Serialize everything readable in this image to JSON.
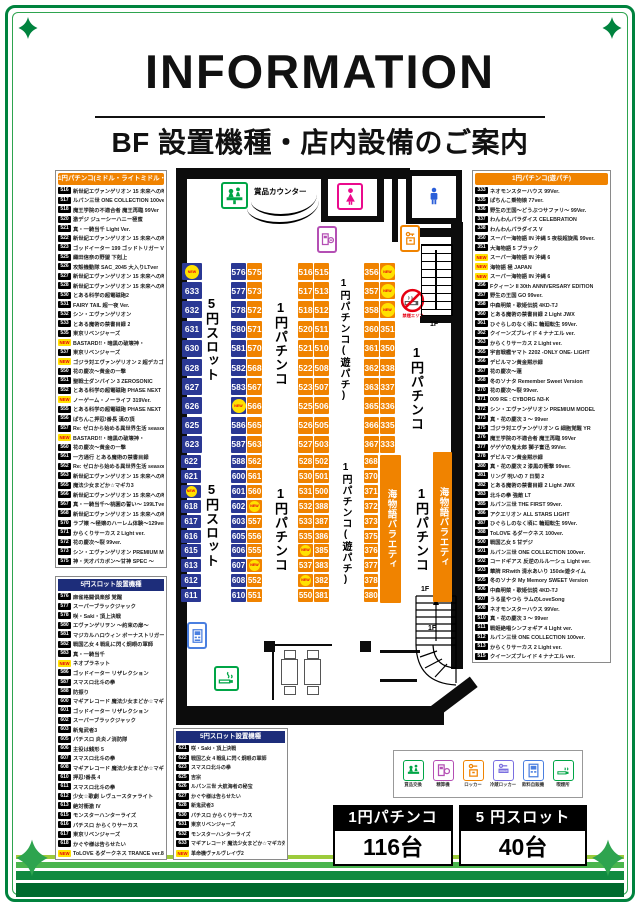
{
  "header": {
    "title": "INFORMATION",
    "subtitle": "BF 設置機種・店内設備のご案内"
  },
  "colors": {
    "accent_orange": "#f08300",
    "seat_blue": "#2a3894",
    "navy_header": "#1d2d7a",
    "new_yellow": "#ffe100",
    "new_red": "#e60012",
    "frame_green": "#00833e"
  },
  "lists": {
    "pachinko_middle": {
      "title": "1円パチンコ(ミドル・ライトミドル・ライト)",
      "items": [
        {
          "no": "516",
          "name": "新世紀エヴァンゲリオン 15 未来への咆哮 Y"
        },
        {
          "no": "517",
          "name": "ルパン三世 ONE COLLECTION 100ver."
        },
        {
          "no": "518",
          "name": "魔王学院の不適合者 魔王再臨 99Ver"
        },
        {
          "no": "520",
          "name": "激デジ ジューシーハニー極蜜"
        },
        {
          "no": "521",
          "name": "真・一騎当千 Light Ver."
        },
        {
          "no": "522",
          "name": "新世紀エヴァンゲリオン 15 未来への咆哮 F"
        },
        {
          "no": "523",
          "name": "ゴッドイーター 199 ゴッドトリガー VER."
        },
        {
          "no": "525",
          "name": "織田信奈の野望 下剋上"
        },
        {
          "no": "526",
          "name": "攻殻機動隊 SAC_2045 大入りLTver"
        },
        {
          "no": "527",
          "name": "新世紀エヴァンゲリオン 15 未来への咆哮 F"
        },
        {
          "no": "528",
          "name": "新世紀エヴァンゲリオン 15 未来への咆哮 F"
        },
        {
          "no": "530",
          "name": "とある科学の超電磁砲2"
        },
        {
          "no": "531",
          "name": "FAIRY TAIL 超一夜 Ver."
        },
        {
          "no": "532",
          "name": "シン・エヴァンゲリオン"
        },
        {
          "no": "533",
          "name": "とある魔術の禁書目録 2"
        },
        {
          "no": "535",
          "name": "東京リベンジャーズ"
        },
        {
          "no": "NEW",
          "name": "BASTARD!!・暗黒の破壊神・"
        },
        {
          "no": "537",
          "name": "東京リベンジャーズ"
        },
        {
          "no": "NEW",
          "name": "ゴジラ対エヴァンゲリオン 2 超デカゴールド"
        },
        {
          "no": "550",
          "name": "花の慶次〜黄金の一撃"
        },
        {
          "no": "551",
          "name": "聖戦士ダンバイン 3 ZEROSONIC"
        },
        {
          "no": "552",
          "name": "とある科学の超電磁砲 PHASE NEXT"
        },
        {
          "no": "NEW",
          "name": "ノーゲーム・ノーライフ 319Ver."
        },
        {
          "no": "555",
          "name": "とある科学の超電磁砲 PHASE NEXT"
        },
        {
          "no": "556",
          "name": "ぱちんこ押忍!番長 漢の頂"
        },
        {
          "no": "557",
          "name": "Re: ゼロから始める異世界生活 season2"
        },
        {
          "no": "NEW",
          "name": "BASTARD!!・暗黒の破壊神・"
        },
        {
          "no": "560",
          "name": "花の慶次〜黄金の一撃"
        },
        {
          "no": "561",
          "name": "一方通行 とある魔術の禁書目録"
        },
        {
          "no": "562",
          "name": "Re: ゼロから始める異世界生活 season2"
        },
        {
          "no": "563",
          "name": "新世紀エヴァンゲリオン 15 未来への咆哮 F"
        },
        {
          "no": "565",
          "name": "魔法少女まどか☆マギカ3"
        },
        {
          "no": "566",
          "name": "新世紀エヴァンゲリオン 15 未来への咆哮 F"
        },
        {
          "no": "567",
          "name": "真・一騎当千〜桃園の誓い〜 199LTver."
        },
        {
          "no": "568",
          "name": "新世紀エヴァンゲリオン 15 未来への咆哮 F"
        },
        {
          "no": "570",
          "name": "ラブ嬢 〜極嬢のハーレム体験〜129ver."
        },
        {
          "no": "571",
          "name": "からくりサーカス 2 Light ver."
        },
        {
          "no": "572",
          "name": "花の慶次〜裂 99ver."
        },
        {
          "no": "573",
          "name": "シン・エヴァンゲリオン PREMIUM MODEL"
        },
        {
          "no": "575",
          "name": "神・天才バカボン〜甘神 SPEC 〜"
        }
      ]
    },
    "slot_left": {
      "title": "5円スロット設置機種",
      "items": [
        {
          "no": "576",
          "name": "麻雀格闘倶楽部 覚醒"
        },
        {
          "no": "577",
          "name": "スーパーブラックジャック"
        },
        {
          "no": "578",
          "name": "咲・Saki・頂上決戦"
        },
        {
          "no": "580",
          "name": "エヴァンゲリヲン 〜約束の扉〜"
        },
        {
          "no": "581",
          "name": "マジカルハロウィン ボーナストリガー"
        },
        {
          "no": "582",
          "name": "戦国乙女 4 戦乱に閃く炯眼の軍師"
        },
        {
          "no": "583",
          "name": "真・一騎当千"
        },
        {
          "no": "NEW",
          "name": "ネオプラネット"
        },
        {
          "no": "586",
          "name": "ゴッドイーター リザレクション"
        },
        {
          "no": "587",
          "name": "スマスロ北斗の拳"
        },
        {
          "no": "588",
          "name": "防振り"
        },
        {
          "no": "600",
          "name": "マギアレコード 魔法少女まどか☆マギカ外伝"
        },
        {
          "no": "601",
          "name": "ゴッドイーター リザレクション"
        },
        {
          "no": "602",
          "name": "スーパーブラックジャック"
        },
        {
          "no": "603",
          "name": "新鬼武者3"
        },
        {
          "no": "605",
          "name": "パチスロ 炎炎ノ消防隊"
        },
        {
          "no": "606",
          "name": "主役は銭形 5"
        },
        {
          "no": "607",
          "name": "スマスロ北斗の拳"
        },
        {
          "no": "608",
          "name": "マギアレコード 魔法少女まどか☆マギカ外伝"
        },
        {
          "no": "610",
          "name": "押忍!番長 4"
        },
        {
          "no": "611",
          "name": "スマスロ北斗の拳"
        },
        {
          "no": "612",
          "name": "少女☆歌劇 レヴュースタァライト"
        },
        {
          "no": "613",
          "name": "絶対衝激 IV"
        },
        {
          "no": "615",
          "name": "モンスターハンターライズ"
        },
        {
          "no": "616",
          "name": "パチスロ からくりサーカス"
        },
        {
          "no": "617",
          "name": "東京リベンジャーズ"
        },
        {
          "no": "618",
          "name": "かぐや様は告らせたい"
        },
        {
          "no": "NEW",
          "name": "ToLOVE るダークネス TRANCE ver.8.7"
        }
      ]
    },
    "pachinko_yupachi": {
      "title": "1円パチンコ(遊パチ)",
      "items": [
        {
          "no": "333",
          "name": "ネオモンスターハウス 99Ver."
        },
        {
          "no": "335",
          "name": "ぱちんこ乗物娘 77ver."
        },
        {
          "no": "336",
          "name": "野生の王国〜どうぶつサファリ〜 99Ver."
        },
        {
          "no": "337",
          "name": "わんわんパラダイス CELEBRATION"
        },
        {
          "no": "338",
          "name": "わんわんパラダイス V"
        },
        {
          "no": "350",
          "name": "スーパー海物語 IN 沖縄 5 夜桜超旋風 99ver."
        },
        {
          "no": "351",
          "name": "大海物語 5 ブラック"
        },
        {
          "no": "NEW",
          "name": "スーパー海物語 IN 沖縄 6"
        },
        {
          "no": "NEW",
          "name": "海物語 極 JAPAN"
        },
        {
          "no": "NEW",
          "name": "スーパー海物語 IN 沖縄 6"
        },
        {
          "no": "356",
          "name": "Fクィーン II 30th ANNIVERSARY EDITION"
        },
        {
          "no": "357",
          "name": "野生の王国 GO 99ver."
        },
        {
          "no": "358",
          "name": "中森明菜・歌姫伝説 4KD-TJ"
        },
        {
          "no": "360",
          "name": "とある魔術の禁書目録 2 Light JWX"
        },
        {
          "no": "361",
          "name": "ひぐらしのなく頃に 輪廻転生 99Ver."
        },
        {
          "no": "362",
          "name": "クイーンズブレイド 4 ナナエル ver."
        },
        {
          "no": "363",
          "name": "からくりサーカス 2 Light ver."
        },
        {
          "no": "365",
          "name": "宇宙戦艦ヤマト 2202 -ONLY ONE- LIGHT"
        },
        {
          "no": "366",
          "name": "デビルマン黄金黙示録"
        },
        {
          "no": "367",
          "name": "花の慶次〜蓮"
        },
        {
          "no": "368",
          "name": "冬のソナタ Remember Sweet Version"
        },
        {
          "no": "370",
          "name": "花の慶次〜裂 99ver."
        },
        {
          "no": "371",
          "name": "009 RE : CYBORG N3-K"
        },
        {
          "no": "372",
          "name": "シン・エヴァンゲリオン PREMIUM MODEL"
        },
        {
          "no": "373",
          "name": "真・花の慶次 3 〜 99ver"
        },
        {
          "no": "375",
          "name": "ゴジラ対エヴァンゲリオン G 細胞覚醒 YR"
        },
        {
          "no": "376",
          "name": "魔王学院の不適合者 魔王再臨 99Ver"
        },
        {
          "no": "377",
          "name": "ゲゲゲの鬼太郎 獅子奮迅 99Ver."
        },
        {
          "no": "378",
          "name": "デビルマン黄金黙示録"
        },
        {
          "no": "380",
          "name": "真・花の慶次 2 漆黒の衝撃 99ver."
        },
        {
          "no": "381",
          "name": "リング 呪いの 7 日間 2"
        },
        {
          "no": "382",
          "name": "とある魔術の禁書目録 2 Light JWX"
        },
        {
          "no": "383",
          "name": "北斗の拳 強敵 LT"
        },
        {
          "no": "385",
          "name": "ルパン三世 THE FIRST 99ver."
        },
        {
          "no": "386",
          "name": "アクエリオン ALL STARS LIGHT"
        },
        {
          "no": "387",
          "name": "ひぐらしのなく頃に 輪廻転生 99Ver."
        },
        {
          "no": "388",
          "name": "ToLOVE るダークネス 100ver."
        },
        {
          "no": "500",
          "name": "戦国乙女 5 甘デジ"
        },
        {
          "no": "501",
          "name": "ルパン三世 ONE COLLECTION 100ver."
        },
        {
          "no": "502",
          "name": "コードギアス 反逆のルルーシュ Light ver."
        },
        {
          "no": "503",
          "name": "華牌 RRwith 清水あいり 150de遊タイム"
        },
        {
          "no": "505",
          "name": "冬のソナタ My Memory SWEET Version"
        },
        {
          "no": "506",
          "name": "中森明菜・歌姫伝説 4KD-TJ"
        },
        {
          "no": "507",
          "name": "うる星やつら ラムのLoveSong"
        },
        {
          "no": "508",
          "name": "ネオモンスターハウス 99Ver."
        },
        {
          "no": "510",
          "name": "真・花の慶次 3 〜 99ver"
        },
        {
          "no": "511",
          "name": "戦姫絶唱シンフォギア 4 Light ver."
        },
        {
          "no": "512",
          "name": "ルパン三世 ONE COLLECTION 100ver."
        },
        {
          "no": "513",
          "name": "からくりサーカス 2 Light ver."
        },
        {
          "no": "515",
          "name": "クイーンズブレイド 4 ナナエル ver."
        }
      ]
    },
    "slot_bottom": {
      "title": "5円スロット設置機種",
      "items": [
        {
          "no": "621",
          "name": "咲・Saki・頂上決戦"
        },
        {
          "no": "622",
          "name": "戦国乙女 4 戦乱に閃く炯眼の軍師"
        },
        {
          "no": "623",
          "name": "スマスロ北斗の拳"
        },
        {
          "no": "625",
          "name": "吉宗"
        },
        {
          "no": "626",
          "name": "ルパン三世 大航海者の秘宝"
        },
        {
          "no": "627",
          "name": "かぐや様は告らせたい"
        },
        {
          "no": "628",
          "name": "新鬼武者3"
        },
        {
          "no": "630",
          "name": "パチスロ からくりサーカス"
        },
        {
          "no": "631",
          "name": "東京リベンジャーズ"
        },
        {
          "no": "632",
          "name": "モンスターハンターライズ"
        },
        {
          "no": "633",
          "name": "マギアレコード 魔法少女まどか☆マギカ外伝"
        },
        {
          "no": "NEW",
          "name": "革命機ヴァルヴレイヴ2"
        }
      ]
    }
  },
  "map": {
    "prize_counter_label": "賞品カウンター",
    "no_smoking_label": "禁煙エリア",
    "seat_columns": [
      {
        "x": 182,
        "y": 263,
        "w": 20,
        "pitch": 19.2,
        "h": 17,
        "color": "blue",
        "cells": [
          "NEW",
          "633",
          "632",
          "631",
          "630",
          "628",
          "627",
          "626",
          "625",
          "623"
        ]
      },
      {
        "x": 231,
        "y": 263,
        "w": 15,
        "pitch": 19.2,
        "h": 17,
        "color": "blue",
        "cells": [
          "576",
          "577",
          "578",
          "580",
          "581",
          "582",
          "583",
          "NEW",
          "586",
          "587"
        ]
      },
      {
        "x": 247,
        "y": 263,
        "w": 15,
        "pitch": 19.2,
        "h": 17,
        "color": "orange",
        "cells": [
          "575",
          "573",
          "572",
          "571",
          "570",
          "568",
          "567",
          "566",
          "565",
          "563"
        ]
      },
      {
        "x": 298,
        "y": 263,
        "w": 15,
        "pitch": 19.2,
        "h": 17,
        "color": "orange",
        "cells": [
          "516",
          "517",
          "518",
          "520",
          "521",
          "522",
          "523",
          "525",
          "526",
          "527"
        ]
      },
      {
        "x": 314,
        "y": 263,
        "w": 15,
        "pitch": 19.2,
        "h": 17,
        "color": "orange",
        "cells": [
          "515",
          "513",
          "512",
          "511",
          "510",
          "508",
          "507",
          "506",
          "505",
          "503"
        ]
      },
      {
        "x": 364,
        "y": 263,
        "w": 15,
        "pitch": 19.2,
        "h": 17,
        "color": "orange",
        "cells": [
          "356",
          "357",
          "358",
          "360",
          "361",
          "362",
          "363",
          "365",
          "366",
          "367"
        ]
      },
      {
        "x": 380,
        "y": 263,
        "w": 15,
        "pitch": 19.2,
        "h": 17,
        "color": "orange",
        "cells": [
          "NEW",
          "NEW",
          "NEW",
          "351",
          "350",
          "338",
          "337",
          "336",
          "335",
          "333"
        ]
      },
      {
        "x": 181,
        "y": 455,
        "w": 20,
        "pitch": 14.9,
        "h": 13,
        "color": "blue",
        "cells": [
          "622",
          "621",
          "NEW",
          "618",
          "617",
          "616",
          "615",
          "613",
          "612",
          "611"
        ]
      },
      {
        "x": 231,
        "y": 455,
        "w": 15,
        "pitch": 14.9,
        "h": 13,
        "color": "blue",
        "cells": [
          "588",
          "600",
          "601",
          "602",
          "603",
          "605",
          "606",
          "607",
          "608",
          "610"
        ]
      },
      {
        "x": 247,
        "y": 455,
        "w": 15,
        "pitch": 14.9,
        "h": 13,
        "color": "orange",
        "cells": [
          "562",
          "561",
          "560",
          "NEW",
          "557",
          "556",
          "555",
          "NEW",
          "552",
          "551"
        ]
      },
      {
        "x": 298,
        "y": 455,
        "w": 15,
        "pitch": 14.9,
        "h": 13,
        "color": "orange",
        "cells": [
          "528",
          "530",
          "531",
          "532",
          "533",
          "535",
          "NEW",
          "537",
          "NEW",
          "550"
        ]
      },
      {
        "x": 314,
        "y": 455,
        "w": 15,
        "pitch": 14.9,
        "h": 13,
        "color": "orange",
        "cells": [
          "502",
          "501",
          "500",
          "388",
          "387",
          "386",
          "385",
          "383",
          "382",
          "381"
        ]
      },
      {
        "x": 364,
        "y": 455,
        "w": 14,
        "pitch": 14.9,
        "h": 13,
        "color": "orange",
        "cells": [
          "368",
          "370",
          "371",
          "372",
          "373",
          "375",
          "376",
          "377",
          "378",
          "380"
        ]
      }
    ],
    "vertical_labels": [
      {
        "text": "5円スロット",
        "x": 202,
        "y": 296,
        "size": 13,
        "h": 140
      },
      {
        "text": "1円パチンコ",
        "x": 271,
        "y": 300,
        "size": 13,
        "h": 140
      },
      {
        "text": "1円パチンコ(遊パチ)",
        "x": 336,
        "y": 278,
        "size": 10,
        "h": 178
      },
      {
        "text": "1円パチンコ",
        "x": 407,
        "y": 345,
        "size": 13,
        "h": 140
      },
      {
        "text": "5円スロット",
        "x": 202,
        "y": 482,
        "size": 13,
        "h": 140
      },
      {
        "text": "1円パチンコ",
        "x": 271,
        "y": 486,
        "size": 13,
        "h": 140
      },
      {
        "text": "1円パチンコ(遊パチ)",
        "x": 338,
        "y": 462,
        "size": 10,
        "h": 178
      },
      {
        "text": "1円パチンコ",
        "x": 412,
        "y": 486,
        "size": 13,
        "h": 140
      }
    ],
    "bands": [
      {
        "x": 380,
        "y": 455,
        "w": 21,
        "h": 148,
        "text": "海物語バラエティ"
      },
      {
        "x": 433,
        "y": 452,
        "w": 19,
        "h": 150,
        "text": "海物語バラエティ"
      }
    ],
    "floor_labels": [
      {
        "text": "1F",
        "x": 430,
        "y": 321
      },
      {
        "text": "1F",
        "x": 421,
        "y": 586
      },
      {
        "text": "1F",
        "x": 428,
        "y": 625
      }
    ]
  },
  "legend": {
    "items": [
      {
        "label": "賞品交換"
      },
      {
        "label": "精算機"
      },
      {
        "label": "ロッカー"
      },
      {
        "label": "冷蔵ロッカー",
        "badge": "COLD"
      },
      {
        "label": "飲料自販機"
      },
      {
        "label": "喫煙所"
      }
    ]
  },
  "totals": {
    "items": [
      {
        "label": "1円パチンコ",
        "count": "116台"
      },
      {
        "label": "5 円スロット",
        "count": "40台"
      }
    ]
  }
}
